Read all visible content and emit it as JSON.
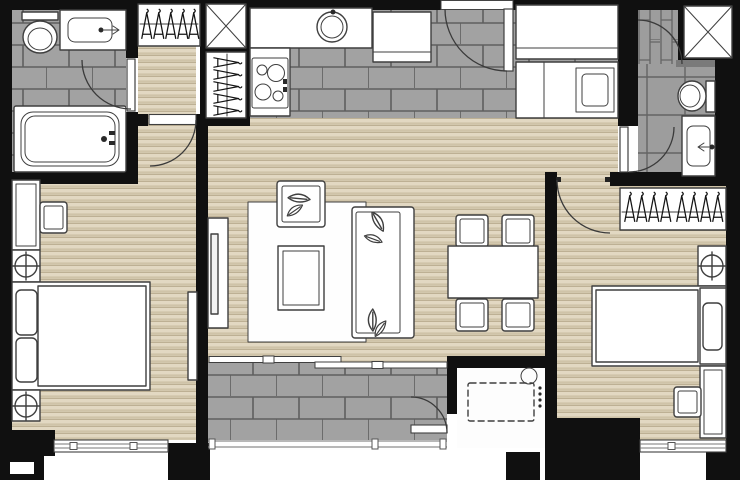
{
  "meta": {
    "kind": "floor-plan",
    "description": "two-bedroom two-bathroom condominium unit floor plan with balcony and ac ledge",
    "canvas": {
      "width": 740,
      "height": 480
    }
  },
  "colors": {
    "wall": "#101010",
    "wood_light": "#e2d8c2",
    "wood_mid": "#cfc3a8",
    "wood_line": "#b9ac8f",
    "tile_fill": "#a2a2a2",
    "tile_grout": "#5f5f5f",
    "tile2_fill": "#9d9d9d",
    "tile2_grout": "#646464",
    "furn_stroke": "#3f3f3f",
    "arc_stroke": "#3a3a3a",
    "hanger": "#141414",
    "rug_fill": "#fefefe",
    "threshold": "#ffffff",
    "shower_curb": "#7a7a7a"
  },
  "counts": {
    "bedrooms": 2,
    "bathrooms": 2,
    "dining_chairs": 4,
    "wardrobes": 3,
    "service_shafts": 2,
    "swing_doors": 7,
    "sliding_doors": 1,
    "windows": 2
  },
  "rooms": [
    {
      "name": "master-bathroom",
      "floor": "gray-brick-tile",
      "fixtures": [
        "toilet",
        "vanity-sink",
        "bathtub",
        "swing-door"
      ]
    },
    {
      "name": "dressing-corridor",
      "floor": "wood",
      "fixtures": [
        "hanging-wardrobe",
        "vertical-hanging-closet",
        "service-shaft-x"
      ]
    },
    {
      "name": "master-bedroom",
      "floor": "wood",
      "fixtures": [
        "desk",
        "desk-chair",
        "nightstand-lamp",
        "double-bed-two-pillows",
        "nightstand-lamp",
        "wall-tv",
        "bottom-window",
        "swing-door"
      ]
    },
    {
      "name": "kitchen-entry",
      "floor": "gray-brick-tile",
      "fixtures": [
        "l-shaped-counter",
        "round-sink",
        "four-burner-hob",
        "refrigerator",
        "entrance-door",
        "tall-cabinet",
        "counter-with-built-in-washer"
      ]
    },
    {
      "name": "living-dining",
      "floor": "wood",
      "fixtures": [
        "tv-console",
        "area-rug",
        "armchair-leaf-cushion",
        "coffee-table",
        "sofa-leaf-cushions",
        "dining-table",
        "four-dining-chairs",
        "sliding-glass-door"
      ]
    },
    {
      "name": "balcony",
      "floor": "gray-brick-tile",
      "fixtures": [
        "railing",
        "door-to-ac-ledge"
      ]
    },
    {
      "name": "ac-ledge",
      "floor": "plain",
      "fixtures": [
        "condenser-dashed-outline",
        "floor-drain"
      ]
    },
    {
      "name": "bedroom-2",
      "floor": "wood",
      "fixtures": [
        "hanging-wardrobe",
        "nightstand-lamp",
        "single-bed",
        "desk",
        "desk-chair",
        "bottom-window",
        "swing-door"
      ]
    },
    {
      "name": "bathroom-2",
      "floor": "gray-tile",
      "fixtures": [
        "shower-stall",
        "shower-door",
        "shower-head",
        "toilet",
        "vanity-sink",
        "swing-door"
      ]
    },
    {
      "name": "service-shaft-2",
      "floor": "none",
      "fixtures": [
        "x-mark"
      ]
    }
  ]
}
